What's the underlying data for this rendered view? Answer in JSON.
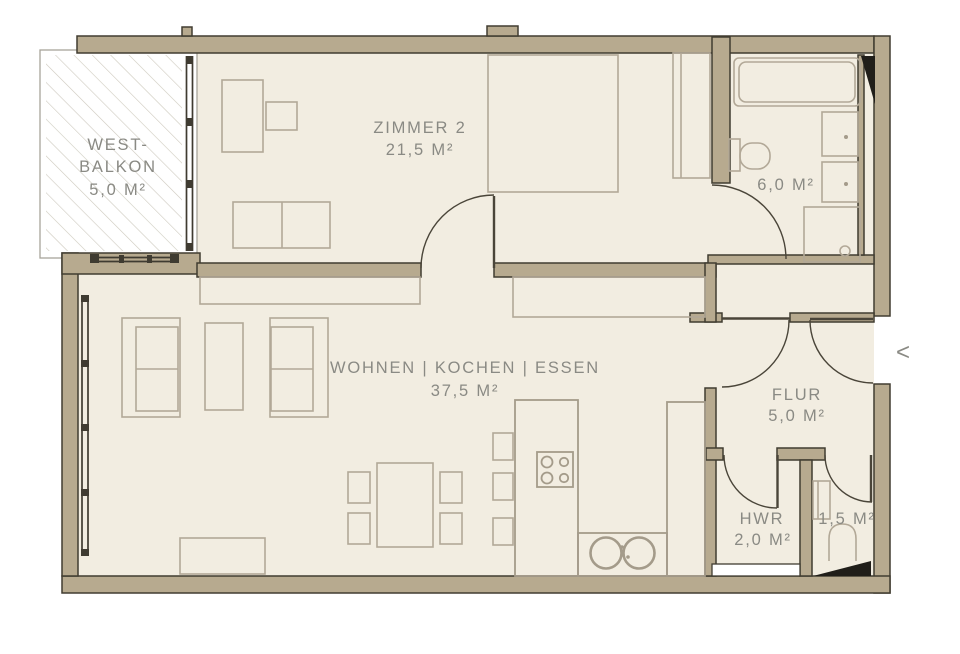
{
  "rooms": {
    "balkon": {
      "name_line1": "WEST-",
      "name_line2": "BALKON",
      "area": "5,0 M²"
    },
    "zimmer2": {
      "name": "ZIMMER 2",
      "area": "21,5 M²"
    },
    "wohnen": {
      "name": "WOHNEN | KOCHEN | ESSEN",
      "area": "37,5 M²"
    },
    "bad": {
      "area": "6,0 M²"
    },
    "flur": {
      "name": "FLUR",
      "area": "5,0 M²"
    },
    "hwr": {
      "name": "HWR",
      "area": "2,0 M²"
    },
    "wc": {
      "area": "1,5 M²"
    }
  },
  "entrance": {
    "arrow": "<"
  },
  "colors": {
    "floor": "#f2ede1",
    "wall": "#b7aa8f",
    "wall_outline": "#403c31",
    "furniture": "#b2a897",
    "counter": "#a49b8a",
    "door": "#4a4539",
    "window": "#3f3b31",
    "text": "#8a8a84",
    "shaft": "#201e19",
    "hatch": "#cdc9be",
    "balcony_border": "#a8a49a"
  }
}
